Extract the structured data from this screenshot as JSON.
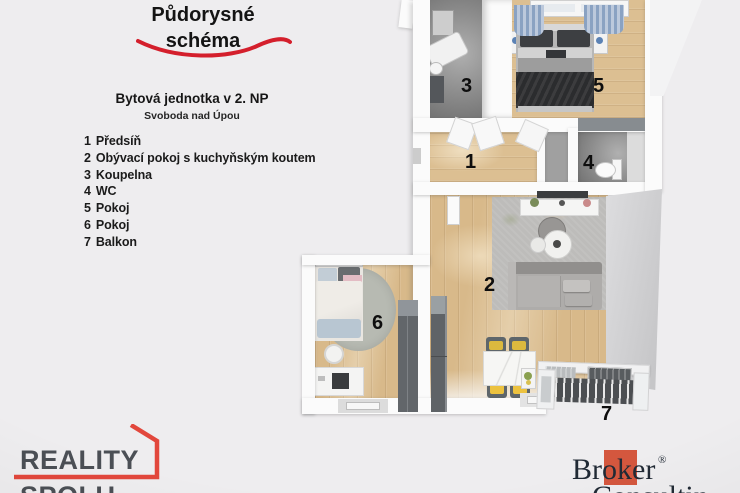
{
  "header": {
    "title_line1": "Půdorysné",
    "title_line2": "schéma",
    "subtitle": "Bytová jednotka v 2. NP",
    "location": "Svoboda nad Úpou",
    "accent": "#d41f2c"
  },
  "legend": {
    "items": [
      {
        "number": "1",
        "label": "Předsíň"
      },
      {
        "number": "2",
        "label": "Obývací pokoj s kuchyňským koutem"
      },
      {
        "number": "3",
        "label": "Koupelna"
      },
      {
        "number": "4",
        "label": "WC"
      },
      {
        "number": "5",
        "label": "Pokoj"
      },
      {
        "number": "6",
        "label": "Pokoj"
      },
      {
        "number": "7",
        "label": "Balkon"
      }
    ]
  },
  "plan": {
    "rooms": [
      {
        "number": "1",
        "name": "Předsíň"
      },
      {
        "number": "2",
        "name": "Obývací pokoj s kuchyňským koutem"
      },
      {
        "number": "3",
        "name": "Koupelna"
      },
      {
        "number": "4",
        "name": "WC"
      },
      {
        "number": "5",
        "name": "Pokoj"
      },
      {
        "number": "6",
        "name": "Pokoj"
      },
      {
        "number": "7",
        "name": "Balkon"
      }
    ]
  },
  "branding": {
    "reality": {
      "line1": "REALITY",
      "line2": "SPOLU",
      "accent": "#e2473c",
      "text_color": "#4b4f55"
    },
    "broker": {
      "pre": "Br",
      "mid": "ok",
      "post": "er",
      "reg": "®",
      "line2": "Consulting",
      "square_color": "#d4573e",
      "text_color": "#212a35"
    }
  }
}
